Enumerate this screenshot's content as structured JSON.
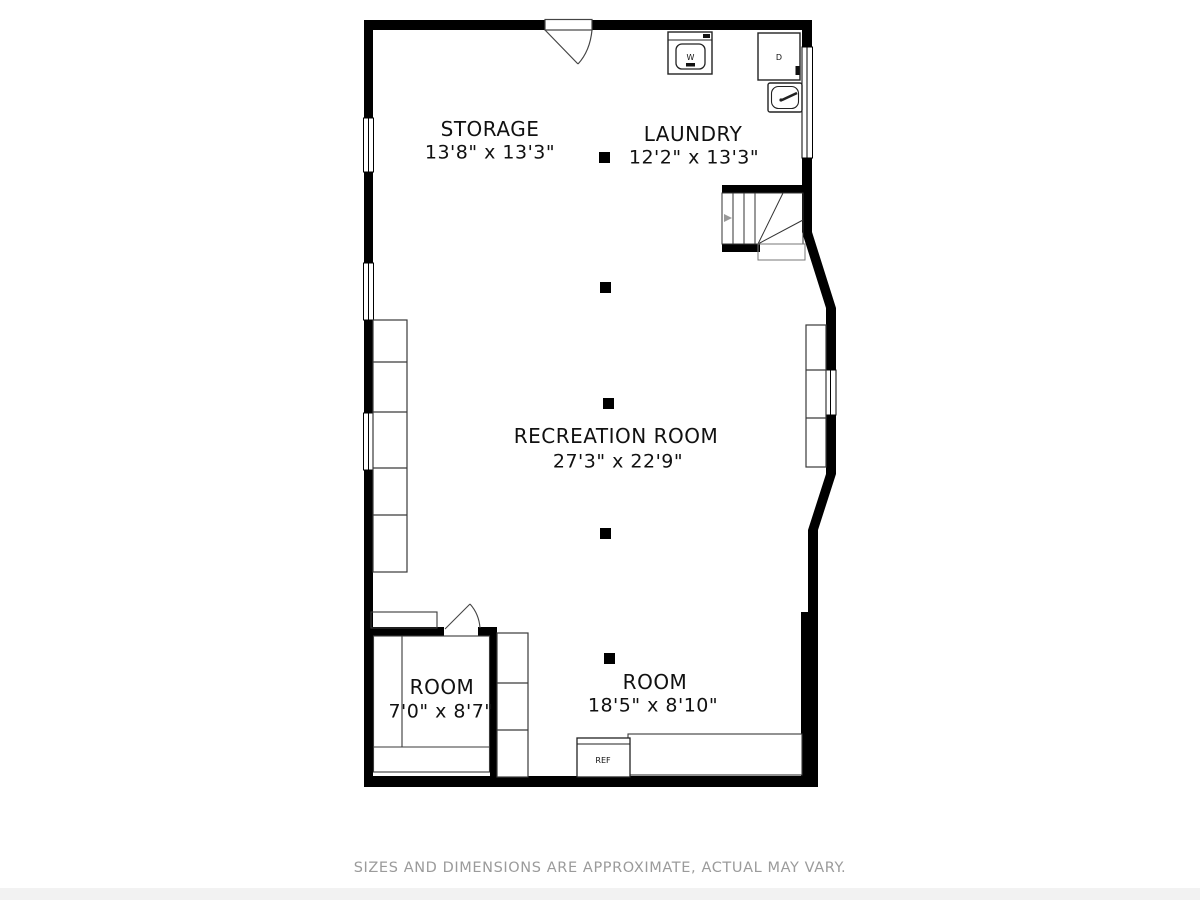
{
  "rooms": [
    {
      "id": "storage",
      "name": "STORAGE",
      "dims": "13'8\" x 13'3\""
    },
    {
      "id": "laundry",
      "name": "LAUNDRY",
      "dims": "12'2\" x 13'3\""
    },
    {
      "id": "recreation",
      "name": "RECREATION ROOM",
      "dims": "27'3\" x 22'9\""
    },
    {
      "id": "room-small",
      "name": "ROOM",
      "dims": "7'0\" x 8'7\""
    },
    {
      "id": "room-large",
      "name": "ROOM",
      "dims": "18'5\" x 8'10\""
    }
  ],
  "appliances": [
    {
      "id": "washer",
      "label": "W"
    },
    {
      "id": "dryer",
      "label": "D"
    },
    {
      "id": "refrigerator",
      "label": "REF"
    }
  ],
  "footer": "SIZES AND DIMENSIONS ARE APPROXIMATE, ACTUAL MAY VARY.",
  "colors": {
    "wall": "#000000",
    "thin_line": "#3a3a3a",
    "footer_text": "#9b9b9b",
    "background": "#ffffff"
  }
}
